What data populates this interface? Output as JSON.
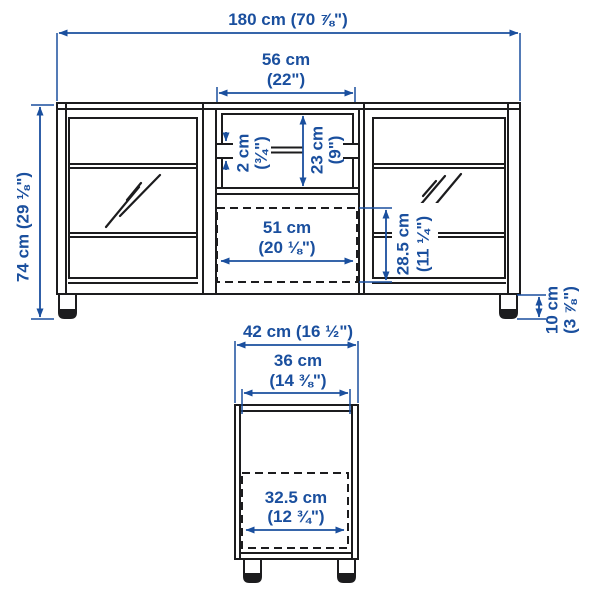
{
  "colors": {
    "dimension_blue": "#1a4f9e",
    "line_black": "#1c1c1e",
    "background": "#ffffff"
  },
  "front_view": {
    "total_width": "180 cm (70 ⅞\")",
    "opening_width_cm": "56 cm",
    "opening_width_in": "(22\")",
    "total_height": "74 cm (29 ⅛\")",
    "shelf_thickness_cm": "2 cm",
    "shelf_thickness_in": "(¾\")",
    "opening_height_cm": "23 cm",
    "opening_height_in": "(9\")",
    "drawer_width_cm": "51 cm",
    "drawer_width_in": "(20 ⅛\")",
    "drawer_height_cm": "28.5 cm",
    "drawer_height_in": "(11 ¼\")",
    "leg_height_cm": "10 cm",
    "leg_height_in": "(3 ⅞\")"
  },
  "side_view": {
    "total_depth": "42 cm (16 ½\")",
    "interior_depth_cm": "36 cm",
    "interior_depth_in": "(14 ⅜\")",
    "drawer_depth_cm": "32.5 cm",
    "drawer_depth_in": "(12 ¾\")"
  }
}
